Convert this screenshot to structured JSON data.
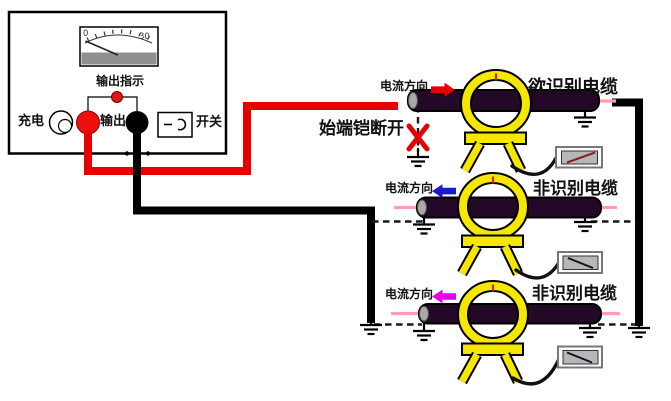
{
  "device": {
    "meter": {
      "scale_min": "0",
      "scale_max": "30",
      "label": "输出指示"
    },
    "charge_label": "充电",
    "output_label": "输出",
    "switch_label": "开关",
    "switch_symbol": "一 ⊃"
  },
  "annotation": {
    "armor_open_label": "始端铠断开"
  },
  "rows": [
    {
      "direction_label": "电流方向",
      "cable_label": "欲识别电缆",
      "arrow_direction": "right",
      "arrow_color": "#e80000"
    },
    {
      "direction_label": "电流方向",
      "cable_label": "非识别电缆",
      "arrow_direction": "left",
      "arrow_color": "#1a1acc"
    },
    {
      "direction_label": "电流方向",
      "cable_label": "非识别电缆",
      "arrow_direction": "left",
      "arrow_color": "#e800e8"
    }
  ],
  "colors": {
    "wire_red": "#e80000",
    "wire_black": "#000000",
    "cable_body": "#230827",
    "cable_whisker_pink": "#ff9fb4",
    "clamp_yellow": "#f5e700",
    "meter_bar_gray": "#8f8f8f",
    "galvo_face_gray": "#b7b7b7",
    "x_mark_red": "#e60000",
    "indicator_dot_red": "#dd1616"
  }
}
